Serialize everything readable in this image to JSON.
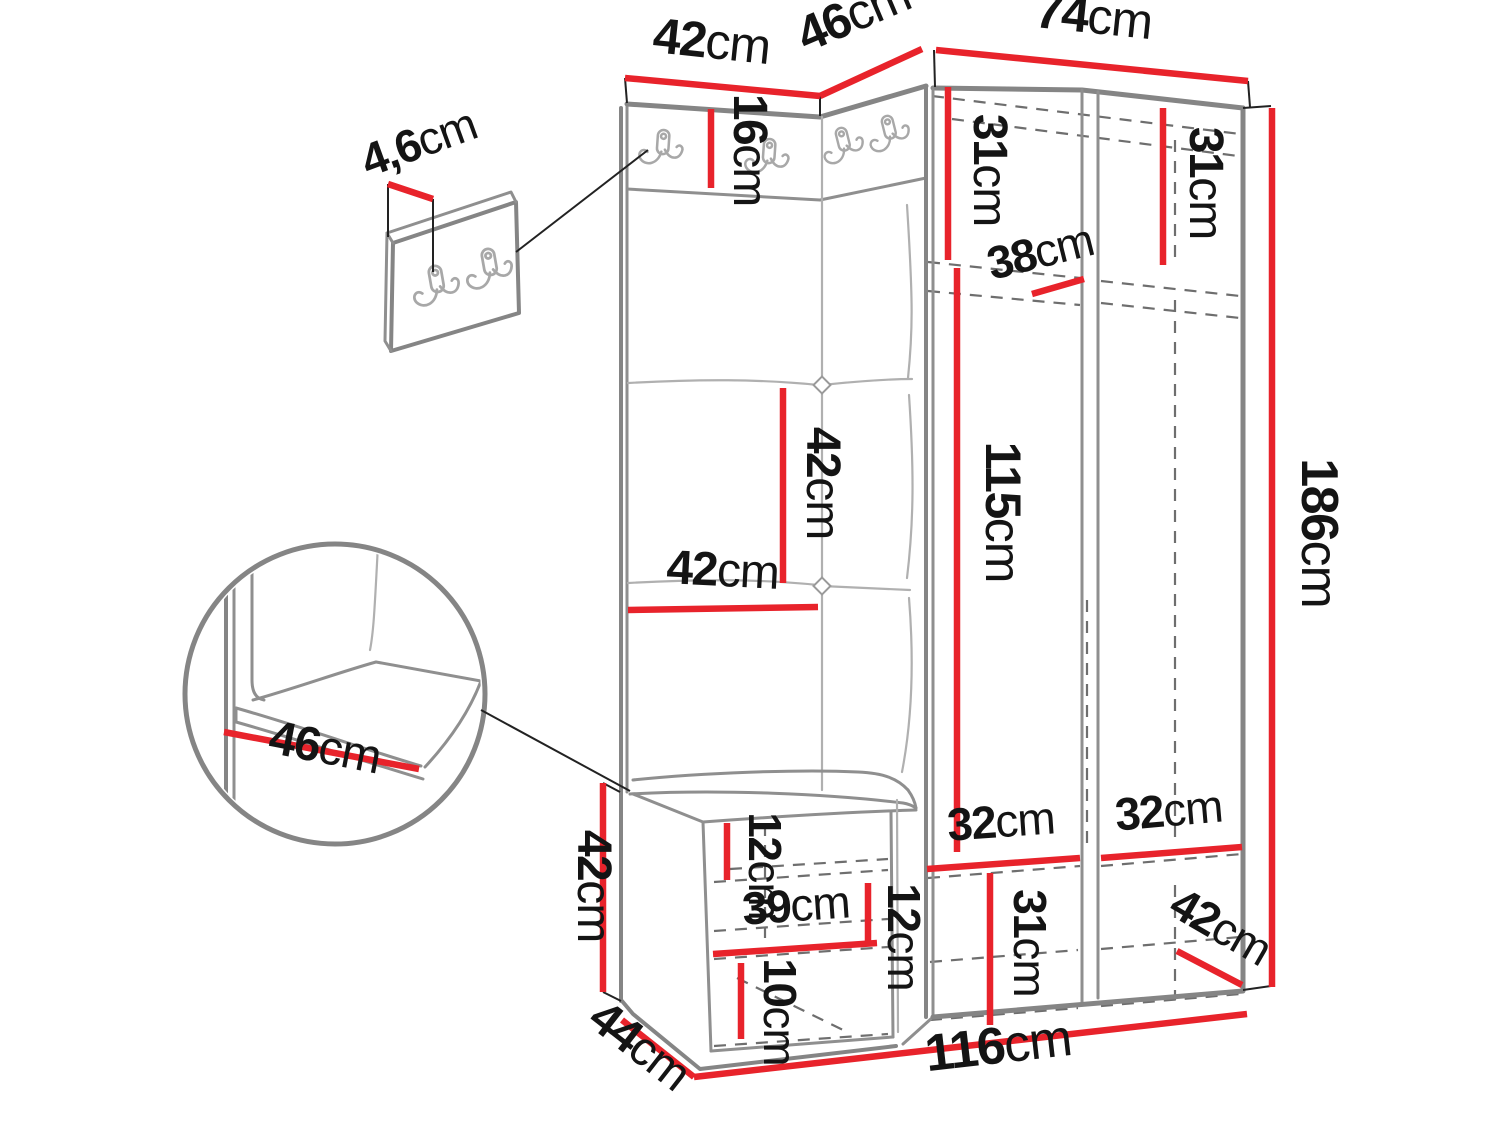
{
  "diagram": {
    "type": "furniture-dimension-drawing",
    "subject": "hallway wardrobe set: coat-hook panels with padded cushions, open wardrobe, bench with shoe shelves, wall hook panel detail and seat-corner detail",
    "unit_suffix": "cm",
    "accent_color": "#e8232b",
    "structure_color": "#858585"
  },
  "labels": {
    "top_left_width": {
      "value": "42",
      "unit": "cm"
    },
    "corner_width": {
      "value": "46",
      "unit": "cm"
    },
    "right_width": {
      "value": "74",
      "unit": "cm"
    },
    "hook_strip_height": {
      "value": "16",
      "unit": "cm"
    },
    "wall_panel_depth": {
      "value": "4,6",
      "unit": "cm"
    },
    "left_top_shelf_height": {
      "value": "31",
      "unit": "cm"
    },
    "right_top_shelf_height": {
      "value": "31",
      "unit": "cm"
    },
    "shelf_depth": {
      "value": "38",
      "unit": "cm"
    },
    "hanging_height": {
      "value": "115",
      "unit": "cm"
    },
    "cushion_height": {
      "value": "42",
      "unit": "cm"
    },
    "cushion_width": {
      "value": "42",
      "unit": "cm"
    },
    "total_height": {
      "value": "186",
      "unit": "cm"
    },
    "seat_depth_detail": {
      "value": "46",
      "unit": "cm"
    },
    "bench_height": {
      "value": "42",
      "unit": "cm"
    },
    "bench_depth": {
      "value": "44",
      "unit": "cm"
    },
    "total_width": {
      "value": "116",
      "unit": "cm"
    },
    "bench_top_clearance": {
      "value": "12",
      "unit": "cm"
    },
    "bench_opening_width": {
      "value": "39",
      "unit": "cm"
    },
    "bench_shelf_gap": {
      "value": "12",
      "unit": "cm"
    },
    "bench_bottom_height": {
      "value": "10",
      "unit": "cm"
    },
    "left_compartment_width": {
      "value": "32",
      "unit": "cm"
    },
    "right_compartment_width": {
      "value": "32",
      "unit": "cm"
    },
    "bottom_compartment_height": {
      "value": "31",
      "unit": "cm"
    },
    "wardrobe_depth": {
      "value": "42",
      "unit": "cm"
    }
  },
  "measurements_cm": {
    "total_width": 116,
    "total_height": 186,
    "bench_depth": 44,
    "wardrobe_depth": 42,
    "left_panel_width": 42,
    "corner_panel_width": 46,
    "wardrobe_width": 74,
    "hook_strip_height": 16,
    "wall_panel_depth": 4.6,
    "top_shelf_heights": [
      31,
      31
    ],
    "shelf_depth": 38,
    "hanging_height": 115,
    "cushion_width": 42,
    "cushion_height": 42,
    "seat_depth": 46,
    "bench_height": 42,
    "bench_top_clearance": 12,
    "bench_opening_width": 39,
    "bench_shelf_gap": 12,
    "bench_bottom_shelf_height": 10,
    "interior_compartment_widths": [
      32,
      32
    ],
    "bottom_compartment_height": 31
  }
}
